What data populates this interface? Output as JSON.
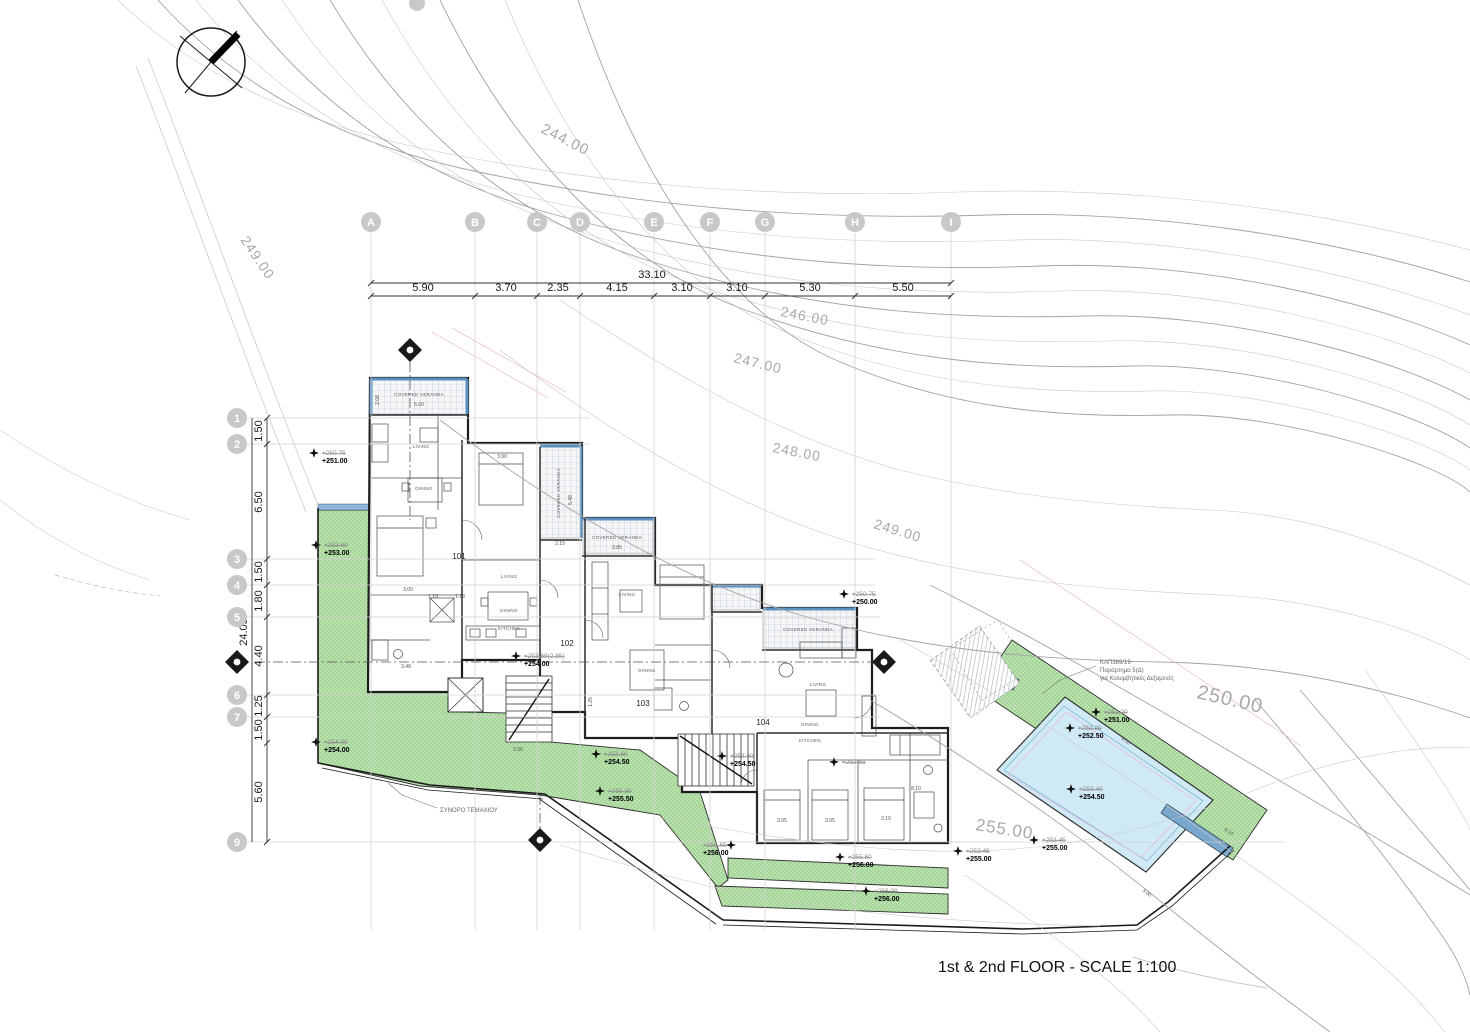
{
  "title": "1st & 2nd FLOOR - SCALE 1:100",
  "grid": {
    "overall_width": "33.10",
    "overall_height": "24.05",
    "columns": [
      "A",
      "B",
      "C",
      "D",
      "E",
      "F",
      "G",
      "H",
      "I"
    ],
    "column_spacings": [
      "5.90",
      "3.70",
      "2.35",
      "4.15",
      "3.10",
      "3.10",
      "5.30",
      "5.50"
    ],
    "rows": [
      "1",
      "2",
      "3",
      "4",
      "5",
      "6",
      "7",
      "9"
    ],
    "row_spacings": [
      "1.50",
      "6.50",
      "1.50",
      "1.80",
      "4.40",
      "1.25",
      "1.50",
      "5.60"
    ]
  },
  "contour_labels": [
    "244.00",
    "249.00",
    "246.00",
    "247.00",
    "248.00",
    "249.00",
    "250.00",
    "255.00"
  ],
  "units": [
    "101",
    "102",
    "103",
    "104"
  ],
  "room_labels": {
    "living": "LIVING",
    "dining": "DINING",
    "kitchen": "KITCHEN",
    "veranda": "COVERED VERANDA"
  },
  "spot_elevations": [
    {
      "old": "+250.75",
      "new": "+251.00"
    },
    {
      "old": "+253.60",
      "new": "+253.00"
    },
    {
      "old": "+254.00",
      "new": "+254.00"
    },
    {
      "old": "+253.65(2.85)",
      "new": "+254.00"
    },
    {
      "old": "+253.60",
      "new": "+254.50"
    },
    {
      "old": "+255.30",
      "new": "+255.50"
    },
    {
      "old": "+253.60",
      "new": "+254.50"
    },
    {
      "old": "+253.65",
      "new": ""
    },
    {
      "old": "+250.75",
      "new": "+250.00"
    },
    {
      "old": "+255.65",
      "new": "+256.00"
    },
    {
      "old": "+255.60",
      "new": "+256.00"
    },
    {
      "old": "+256.00",
      "new": "+256.00"
    },
    {
      "old": "+253.45",
      "new": "+255.00"
    },
    {
      "old": "+253.45",
      "new": "+255.00"
    },
    {
      "old": "+251.00",
      "new": "+251.00"
    },
    {
      "old": "+252.20",
      "new": "+252.50"
    },
    {
      "old": "+253.40",
      "new": "+254.50"
    }
  ],
  "notes": {
    "boundary_label": "ΣΥΝΟΡΟ ΤΕΜΑΧΙΟΥ",
    "pool_note_line1": "ΚΑΠ389/19",
    "pool_note_line2": "Παράρτημα 5(Δ)",
    "pool_note_line3": "για Κολυμβητικές Δεξαμενές"
  },
  "small_dimensions": {
    "veranda1_w": "5.60",
    "veranda1_d": "2.08",
    "veranda2_d": "5.48",
    "veranda2_w": "2.15",
    "veranda3_w": "3.85",
    "bed1": "3.90",
    "stair": "2.50",
    "d1": "1.19",
    "d2": "1.28",
    "d3": "3.00",
    "d4": "3.48",
    "d5": "3.05",
    "d6": "3.10",
    "d7": "1.25",
    "pool_edge": "8.00",
    "pool_end": "3.00",
    "band": "8.10"
  },
  "colors": {
    "green": "#b9e0ad",
    "green_hatch": "#96cf8c",
    "pool": "#cfeaf5",
    "veranda_edge": "#5b8fc0",
    "wall_strip": "#7aa7cc",
    "contour": "#a9a9a9",
    "grid_bubble": "#c8c8c8"
  }
}
